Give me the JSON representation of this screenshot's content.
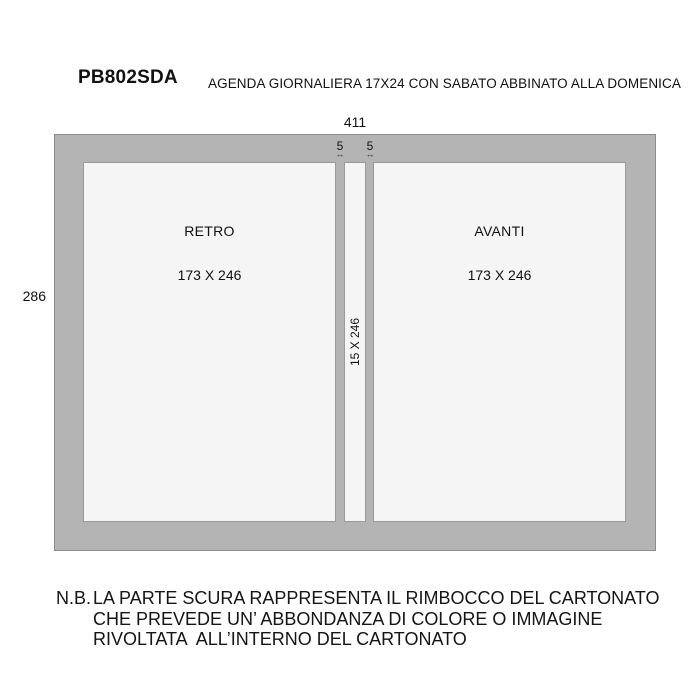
{
  "header": {
    "code": "PB802SDA",
    "title": "AGENDA GIORNALIERA 17X24 CON SABATO ABBINATO ALLA DOMENICA"
  },
  "diagram": {
    "overall_width": "411",
    "overall_height": "286",
    "gap_left": "5",
    "gap_right": "5",
    "gap_arrow_icon": "↔",
    "back_panel": {
      "label": "RETRO",
      "size": "173 X 246"
    },
    "front_panel": {
      "label": "AVANTI",
      "size": "173 X 246"
    },
    "spine": {
      "size": "15 X 246"
    },
    "colors": {
      "fold_area": "#b4b4b4",
      "fold_border": "#8d8d8d",
      "panel_fill": "#f5f5f5",
      "panel_border": "#9a9a9a"
    }
  },
  "note": {
    "prefix": "N.B.",
    "lines": [
      "LA PARTE SCURA RAPPRESENTA IL RIMBOCCO DEL CARTONATO",
      "CHE PREVEDE UN’ ABBONDANZA DI COLORE O IMMAGINE",
      "RIVOLTATA  ALL’INTERNO DEL CARTONATO"
    ]
  }
}
